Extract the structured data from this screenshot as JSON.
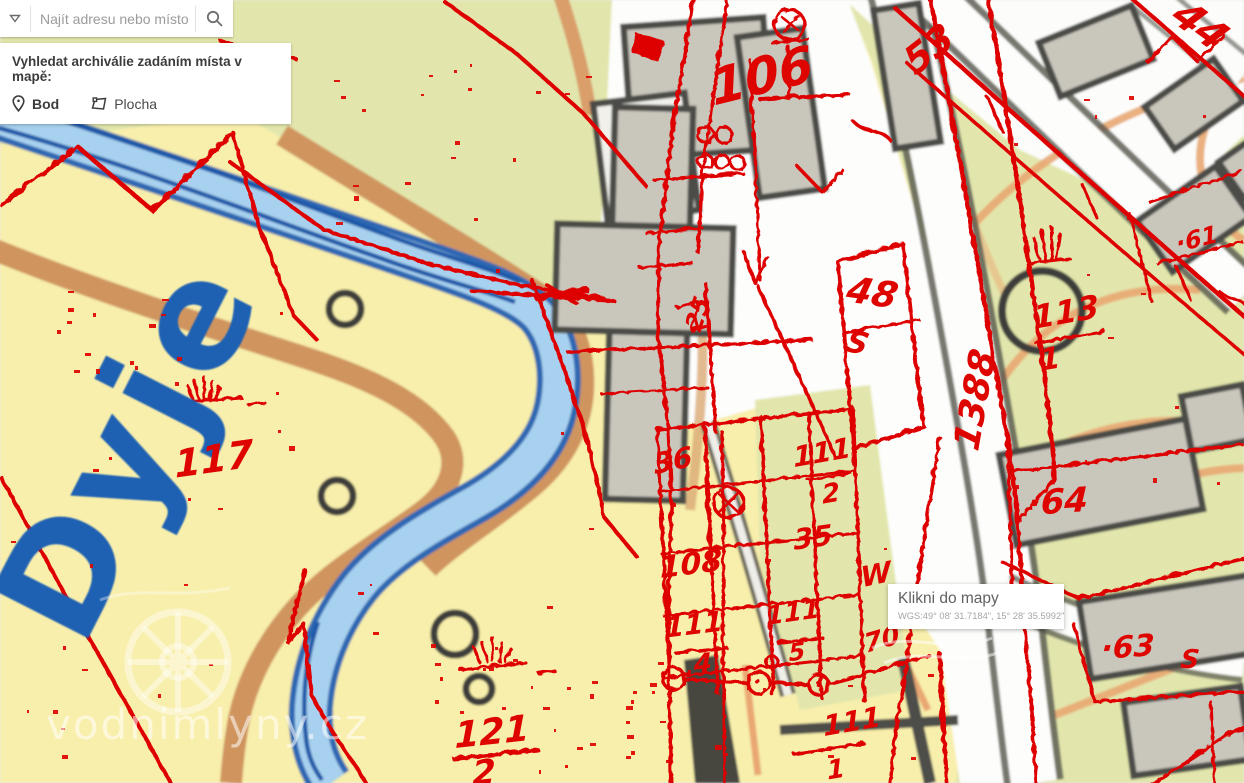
{
  "search": {
    "placeholder": "Najít adresu nebo místo"
  },
  "panel": {
    "title": "Vyhledat archiválie zadáním místa v mapě:",
    "options": [
      {
        "label": "Bod"
      },
      {
        "label": "Plocha"
      }
    ]
  },
  "tooltip": {
    "title": "Klikni do mapy",
    "coords": "WGS:49° 08' 31.7184\", 15° 28' 35.5992\""
  },
  "watermark": {
    "text": "vodnimlyny.cz"
  },
  "map": {
    "colors": {
      "field_yellow": "#F8EFAC",
      "meadow_green": "#E2E6AC",
      "road_white": "#FDFDFB",
      "river_light": "#A7D1EE",
      "river_dark": "#2E68B2",
      "bank_brown": "#D0945F",
      "contour_orange": "#E9A873",
      "building_gray": "#C9C6BC",
      "outline_dark": "#4B4B47",
      "overlay_red": "#DE0400",
      "river_label_blue": "#1E60B2"
    },
    "river_label": {
      "text": "Dyje",
      "x": 128,
      "y": 448,
      "rot": -63,
      "size": 148
    },
    "labels": [
      {
        "text": "106",
        "x": 762,
        "y": 76,
        "rot": -14,
        "size": 50
      },
      {
        "text": "53",
        "x": 929,
        "y": 49,
        "rot": -38,
        "size": 38
      },
      {
        "text": "44",
        "x": 1200,
        "y": 26,
        "rot": 36,
        "size": 40
      },
      {
        "text": "117",
        "x": 214,
        "y": 459,
        "rot": -8,
        "size": 38
      },
      {
        "text": "121",
        "x": 492,
        "y": 733,
        "rot": -6,
        "size": 36
      },
      {
        "text": "2",
        "x": 484,
        "y": 773,
        "rot": -6,
        "size": 34
      },
      {
        "text": "48",
        "x": 872,
        "y": 294,
        "rot": 8,
        "size": 36
      },
      {
        "text": "S",
        "x": 857,
        "y": 344,
        "rot": 10,
        "size": 30
      },
      {
        "text": "1388",
        "x": 976,
        "y": 400,
        "rot": -80,
        "size": 36
      },
      {
        "text": "113",
        "x": 1066,
        "y": 312,
        "rot": -10,
        "size": 32
      },
      {
        "text": "1",
        "x": 1050,
        "y": 360,
        "rot": -10,
        "size": 30
      },
      {
        "text": "·64",
        "x": 1058,
        "y": 502,
        "rot": -4,
        "size": 34
      },
      {
        "text": "·63",
        "x": 1128,
        "y": 648,
        "rot": -4,
        "size": 30
      },
      {
        "text": "S",
        "x": 1190,
        "y": 660,
        "rot": 0,
        "size": 26
      },
      {
        "text": "·61",
        "x": 1197,
        "y": 239,
        "rot": -14,
        "size": 24
      },
      {
        "text": "36",
        "x": 673,
        "y": 461,
        "rot": -12,
        "size": 28
      },
      {
        "text": "108",
        "x": 691,
        "y": 565,
        "rot": -7,
        "size": 30
      },
      {
        "text": "111",
        "x": 694,
        "y": 625,
        "rot": -7,
        "size": 28
      },
      {
        "text": "4",
        "x": 703,
        "y": 664,
        "rot": -7,
        "size": 26
      },
      {
        "text": "111",
        "x": 822,
        "y": 453,
        "rot": -10,
        "size": 28
      },
      {
        "text": "2",
        "x": 831,
        "y": 494,
        "rot": -10,
        "size": 26
      },
      {
        "text": "35",
        "x": 813,
        "y": 538,
        "rot": -8,
        "size": 28
      },
      {
        "text": "111",
        "x": 793,
        "y": 613,
        "rot": -8,
        "size": 26
      },
      {
        "text": "5",
        "x": 797,
        "y": 652,
        "rot": -8,
        "size": 24
      },
      {
        "text": "111",
        "x": 852,
        "y": 722,
        "rot": -10,
        "size": 28
      },
      {
        "text": "1",
        "x": 836,
        "y": 770,
        "rot": -10,
        "size": 26
      },
      {
        "text": "W",
        "x": 876,
        "y": 575,
        "rot": -12,
        "size": 28
      },
      {
        "text": "70",
        "x": 882,
        "y": 640,
        "rot": -16,
        "size": 26
      },
      {
        "text": "25",
        "x": 698,
        "y": 314,
        "rot": -72,
        "size": 24
      }
    ]
  }
}
